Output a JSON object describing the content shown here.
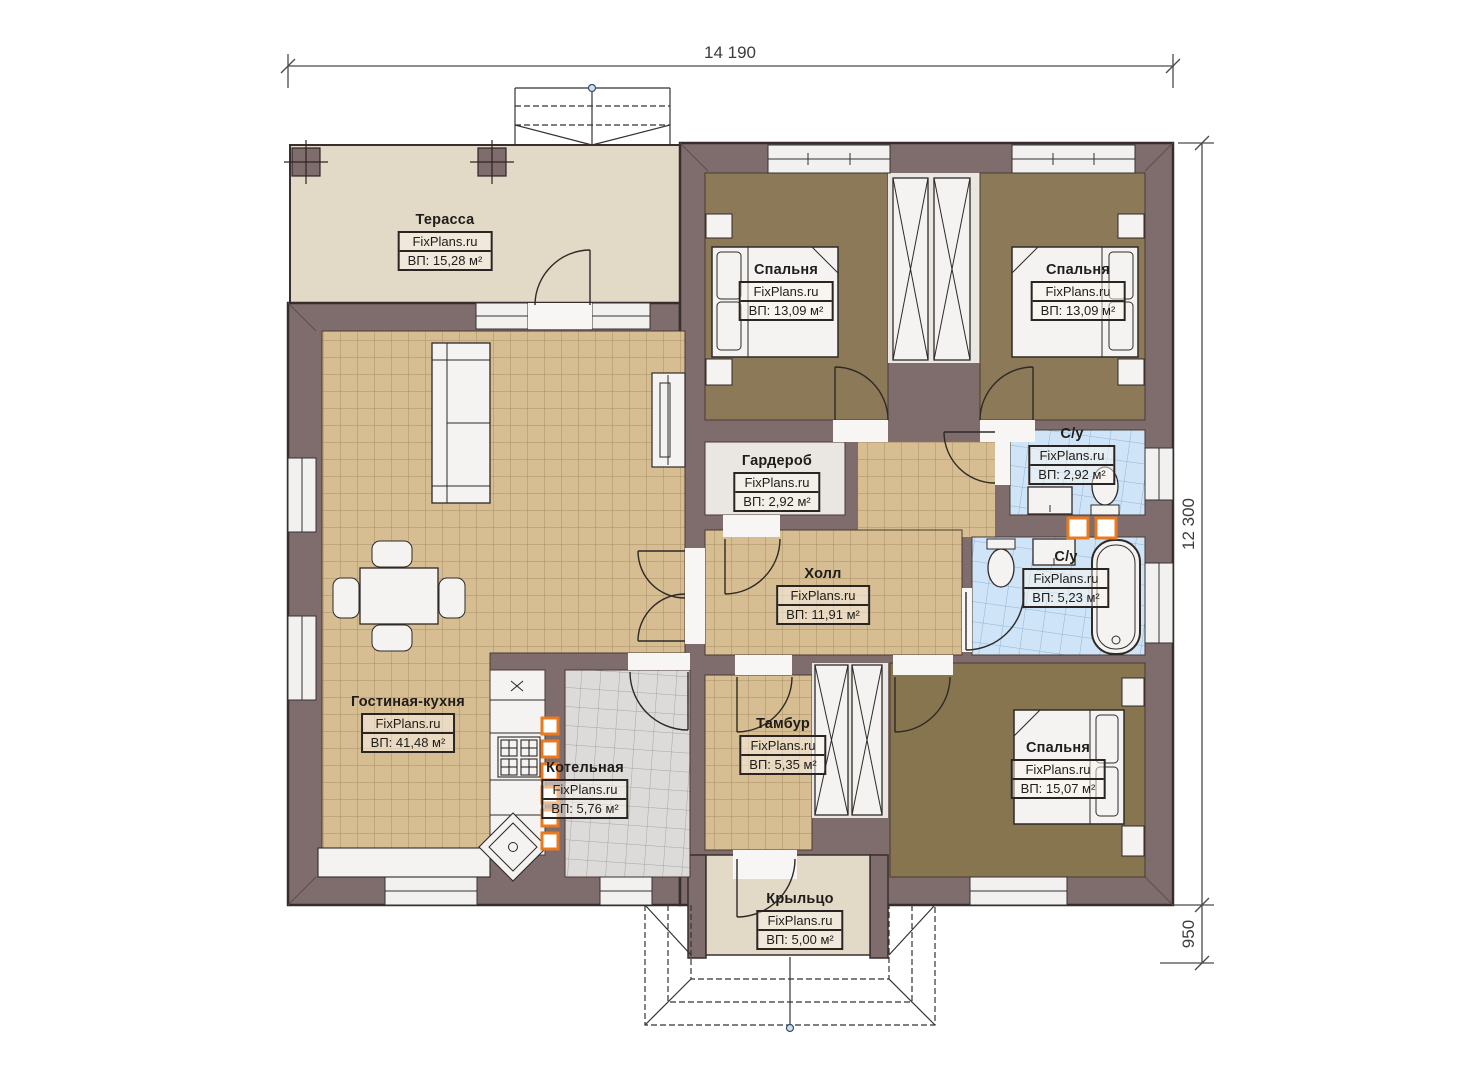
{
  "title": "one-storey house floor plan",
  "watermark": "FixPlans.ru",
  "dimensions": {
    "width_label": "14 190",
    "height_label": "12 300",
    "porch_label": "950"
  },
  "rooms": [
    {
      "id": "terrace",
      "name": "Терасса",
      "brand": "FixPlans.ru",
      "area": "ВП: 15,28 м²"
    },
    {
      "id": "bedroom-1",
      "name": "Спальня",
      "brand": "FixPlans.ru",
      "area": "ВП: 13,09 м²"
    },
    {
      "id": "bedroom-2",
      "name": "Спальня",
      "brand": "FixPlans.ru",
      "area": "ВП: 13,09 м²"
    },
    {
      "id": "wardrobe",
      "name": "Гардероб",
      "brand": "FixPlans.ru",
      "area": "ВП: 2,92 м²"
    },
    {
      "id": "bathroom-small",
      "name": "С/у",
      "brand": "FixPlans.ru",
      "area": "ВП: 2,92 м²"
    },
    {
      "id": "hall",
      "name": "Холл",
      "brand": "FixPlans.ru",
      "area": "ВП: 11,91 м²"
    },
    {
      "id": "bathroom-big",
      "name": "С/у",
      "brand": "FixPlans.ru",
      "area": "ВП: 5,23 м²"
    },
    {
      "id": "living-kitchen",
      "name": "Гостиная-кухня",
      "brand": "FixPlans.ru",
      "area": "ВП: 41,48 м²"
    },
    {
      "id": "boiler-room",
      "name": "Котельная",
      "brand": "FixPlans.ru",
      "area": "ВП: 5,76 м²"
    },
    {
      "id": "vestibule",
      "name": "Тамбур",
      "brand": "FixPlans.ru",
      "area": "ВП: 5,35 м²"
    },
    {
      "id": "bedroom-3",
      "name": "Спальня",
      "brand": "FixPlans.ru",
      "area": "ВП: 15,07 м²"
    },
    {
      "id": "porch",
      "name": "Крыльцо",
      "brand": "FixPlans.ru",
      "area": "ВП: 5,00 м²"
    }
  ],
  "colors": {
    "wall": "#7f6c6c",
    "wall_outline": "#382d2d",
    "terrace_floor": "#e3d9c7",
    "tile_tan": "#d6bd92",
    "tile_tan_line": "#aa9066",
    "tile_blue": "#cfe4f6",
    "tile_blue_line": "#8fb4d8",
    "tile_gray": "#dcdbd9",
    "tile_gray_line": "#a7a5a2",
    "bedroom_floor": "#8c7958",
    "niche_floor": "#eae7e3",
    "furniture_fill": "#f4f3f1",
    "accent_orange": "#e87a20"
  }
}
